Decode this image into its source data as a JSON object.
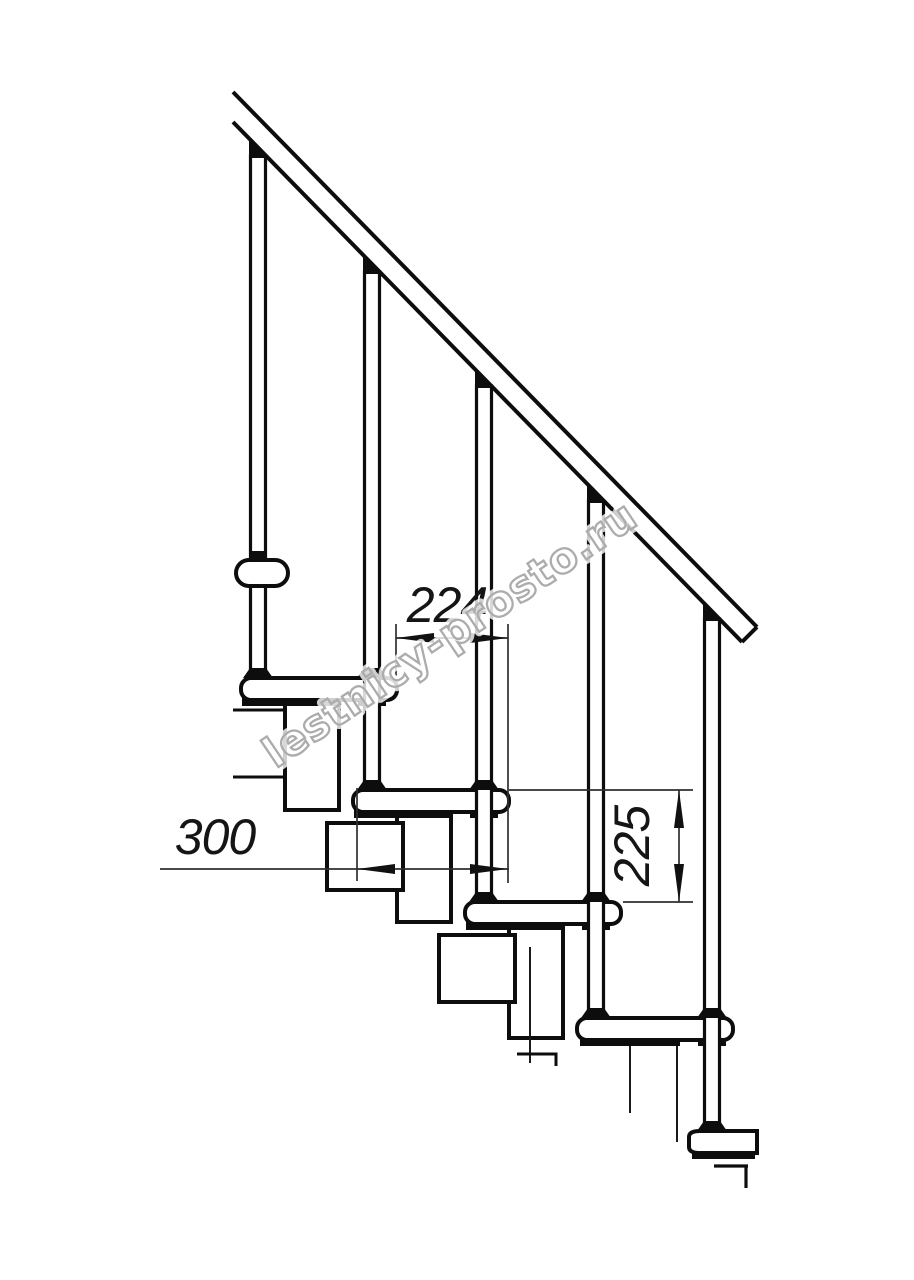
{
  "drawing": {
    "type": "technical drawing",
    "subject": "modular staircase side elevation with handrail and balusters",
    "background": "#ffffff",
    "ink_color": "#0d0d0d",
    "dimension_color": "#151515"
  },
  "dimensions": {
    "tread_offset": {
      "value": "224",
      "orientation": "horizontal"
    },
    "step_run": {
      "value": "300",
      "orientation": "horizontal"
    },
    "riser_height": {
      "value": "225",
      "orientation": "vertical"
    }
  },
  "watermark": {
    "text": "lestnicy-prosto.ru",
    "color": "#acacac"
  }
}
